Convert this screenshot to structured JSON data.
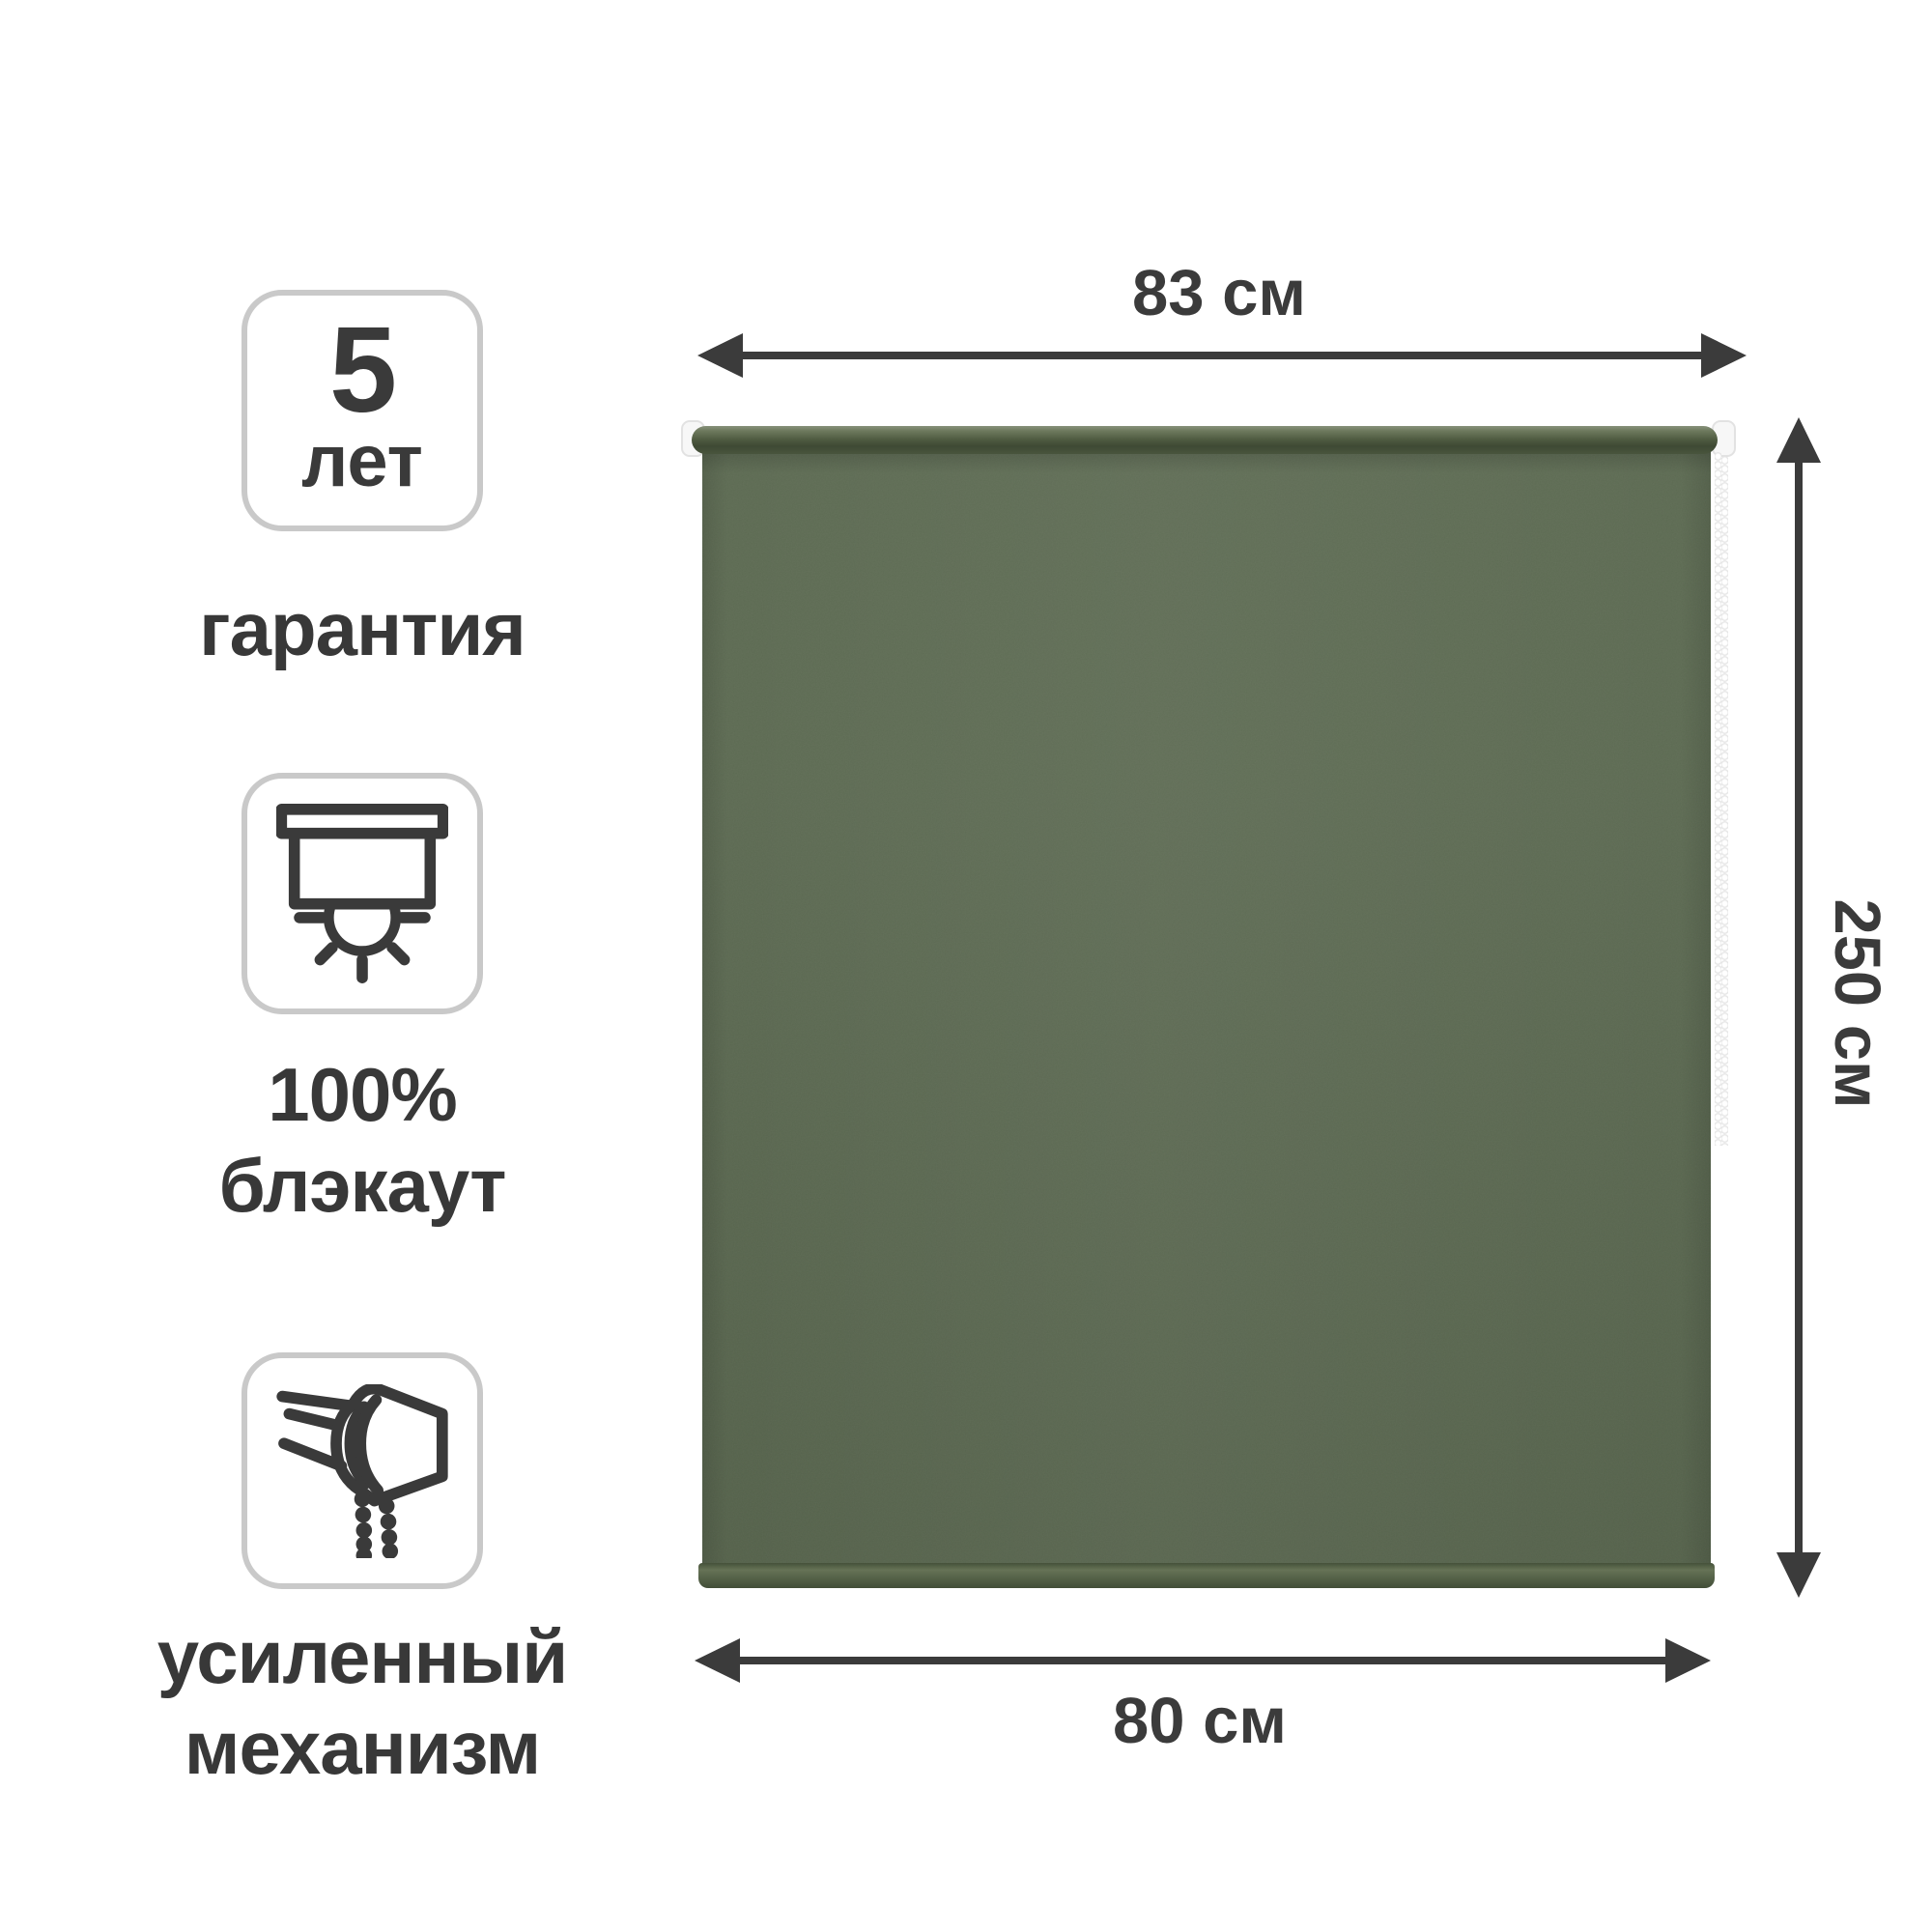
{
  "badges": {
    "warranty": {
      "value": "5",
      "unit": "лет",
      "label": "гарантия"
    },
    "blackout": {
      "line1": "100%",
      "line2": "блэкаут",
      "icon": "blackout-blind-icon"
    },
    "mechanism": {
      "line1": "усиленный",
      "line2": "механизм",
      "icon": "roller-mechanism-icon"
    }
  },
  "dimensions": {
    "top_width": "83 см",
    "height": "250 см",
    "bottom_width": "80 см"
  },
  "colors": {
    "fabric_green": "#59674f",
    "tube_dark_green": "#3e4934",
    "arrow_gray": "#3b3b3b",
    "text_gray": "#383838",
    "badge_border": "#c9c9c9",
    "cap_white": "#f7f7f7",
    "background": "#ffffff"
  }
}
